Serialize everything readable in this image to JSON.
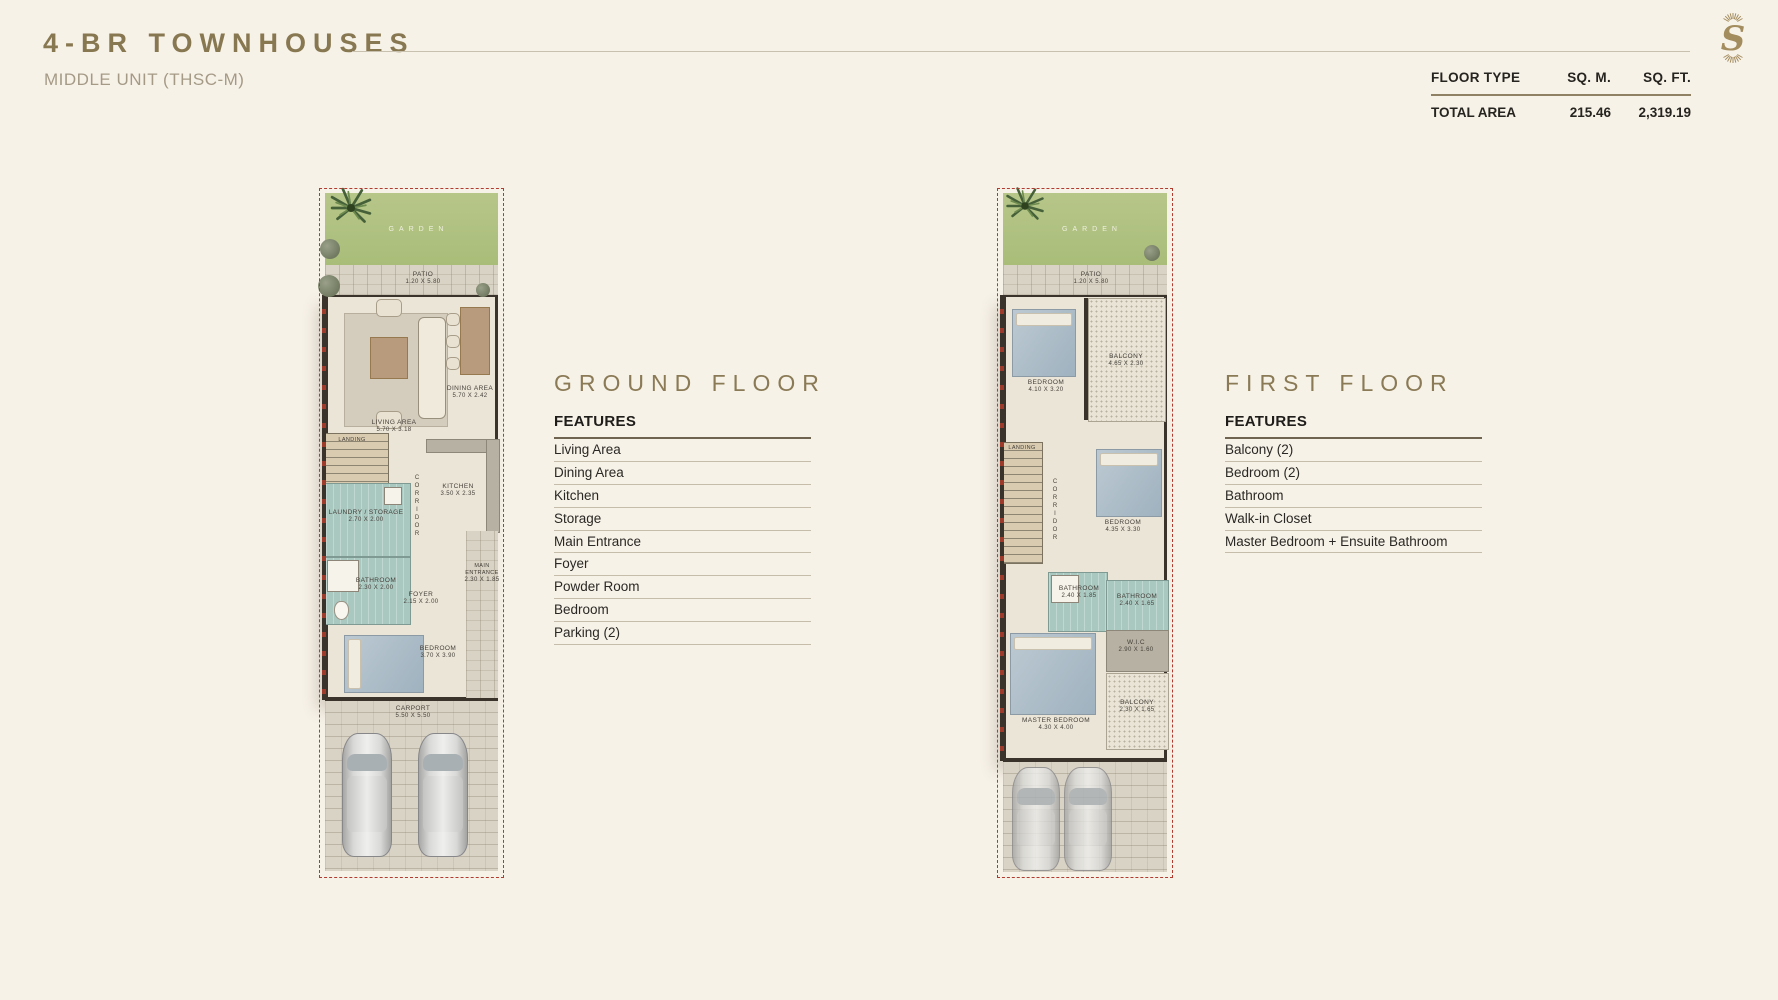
{
  "header": {
    "title": "4-BR TOWNHOUSES",
    "subtitle": "MIDDLE UNIT (THSC-M)"
  },
  "brand": {
    "logo_letter": "S"
  },
  "area_table": {
    "col_floor_type": "FLOOR TYPE",
    "col_sqm": "SQ. M.",
    "col_sqft": "SQ. FT.",
    "row_label": "TOTAL AREA",
    "row_sqm": "215.46",
    "row_sqft": "2,319.19"
  },
  "ground": {
    "heading": "GROUND FLOOR",
    "features_title": "FEATURES",
    "features": [
      "Living Area",
      "Dining Area",
      "Kitchen",
      "Storage",
      "Main Entrance",
      "Foyer",
      "Powder Room",
      "Bedroom",
      "Parking (2)"
    ]
  },
  "first": {
    "heading": "FIRST FLOOR",
    "features_title": "FEATURES",
    "features": [
      "Balcony (2)",
      "Bedroom (2)",
      "Bathroom",
      "Walk-in Closet",
      "Master Bedroom + Ensuite Bathroom"
    ]
  },
  "colors": {
    "accent_gold": "#8a7a55",
    "plan_boundary_red": "#b23b30",
    "background_cream": "#f7f2e8"
  },
  "ground_plan": {
    "garden": {
      "name": "GARDEN"
    },
    "patio": {
      "name": "PATIO",
      "dims": "1.20 X 5.80"
    },
    "living": {
      "name": "LIVING AREA",
      "dims": "5.70 X 3.18"
    },
    "dining": {
      "name": "DINING AREA",
      "dims": "5.70 X 2.42"
    },
    "landing": {
      "name": "LANDING"
    },
    "corridor": {
      "name": "CORRIDOR"
    },
    "kitchen": {
      "name": "KITCHEN",
      "dims": "3.50 X 2.35"
    },
    "laundry": {
      "name": "LAUNDRY / STORAGE",
      "dims": "2.70 X 2.00"
    },
    "bathroom": {
      "name": "BATHROOM",
      "dims": "2.30 X 2.00"
    },
    "foyer": {
      "name": "FOYER",
      "dims": "2.15 X 2.00"
    },
    "entrance": {
      "name": "MAIN ENTRANCE",
      "dims": "2.30 X 1.85"
    },
    "bedroom": {
      "name": "BEDROOM",
      "dims": "3.70 X 3.90"
    },
    "carport": {
      "name": "CARPORT",
      "dims": "5.50 X 5.50"
    }
  },
  "first_plan": {
    "garden": {
      "name": "GARDEN"
    },
    "patio": {
      "name": "PATIO",
      "dims": "1.20 X 5.80"
    },
    "bedroom1": {
      "name": "BEDROOM",
      "dims": "4.10 X 3.20"
    },
    "balcony1": {
      "name": "BALCONY",
      "dims": "4.65 X 2.30"
    },
    "landing": {
      "name": "LANDING"
    },
    "corridor": {
      "name": "CORRIDOR"
    },
    "bedroom2": {
      "name": "BEDROOM",
      "dims": "4.35 X 3.30"
    },
    "bathroom1": {
      "name": "BATHROOM",
      "dims": "2.40 X 1.85"
    },
    "bathroom2": {
      "name": "BATHROOM",
      "dims": "2.40 X 1.65"
    },
    "wic": {
      "name": "W.I.C",
      "dims": "2.90 X 1.60"
    },
    "master": {
      "name": "MASTER BEDROOM",
      "dims": "4.30 X 4.00"
    },
    "balcony2": {
      "name": "BALCONY",
      "dims": "2.30 X 1.65"
    }
  }
}
